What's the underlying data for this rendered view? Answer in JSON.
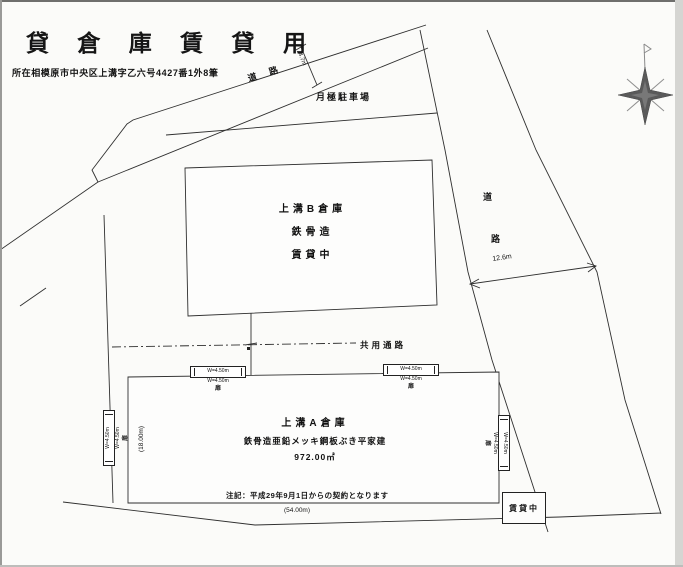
{
  "header": {
    "title": "貸 倉 庫 賃 貸 用",
    "address": "所在相模原市中央区上溝字乙六号4427番1外8筆"
  },
  "roads": {
    "top": {
      "label": "道路",
      "width": "4.7m"
    },
    "right": {
      "char_top": "道",
      "char_bottom": "路",
      "width": "12.6m"
    }
  },
  "parking": {
    "label": "月極駐車場"
  },
  "building_b": {
    "name": "上溝B倉庫",
    "structure": "鉄骨造",
    "status": "賃貸中"
  },
  "passage": {
    "label": "共用通路"
  },
  "building_a": {
    "name": "上溝A倉庫",
    "structure": "鉄骨造亜鉛メッキ鋼板ぶき平家建",
    "area": "972.00㎡",
    "note": "注記：平成29年9月1日からの契約となります",
    "frontage": "(54.00m)",
    "depth": "(18.00m)"
  },
  "shutter": {
    "width": "W=4.50m",
    "door": "扉"
  },
  "status_box": {
    "label": "賃貸中"
  },
  "colors": {
    "line": "#2f2f2f",
    "compass": "#5a5a5a",
    "paper": "#fbfbf9"
  }
}
